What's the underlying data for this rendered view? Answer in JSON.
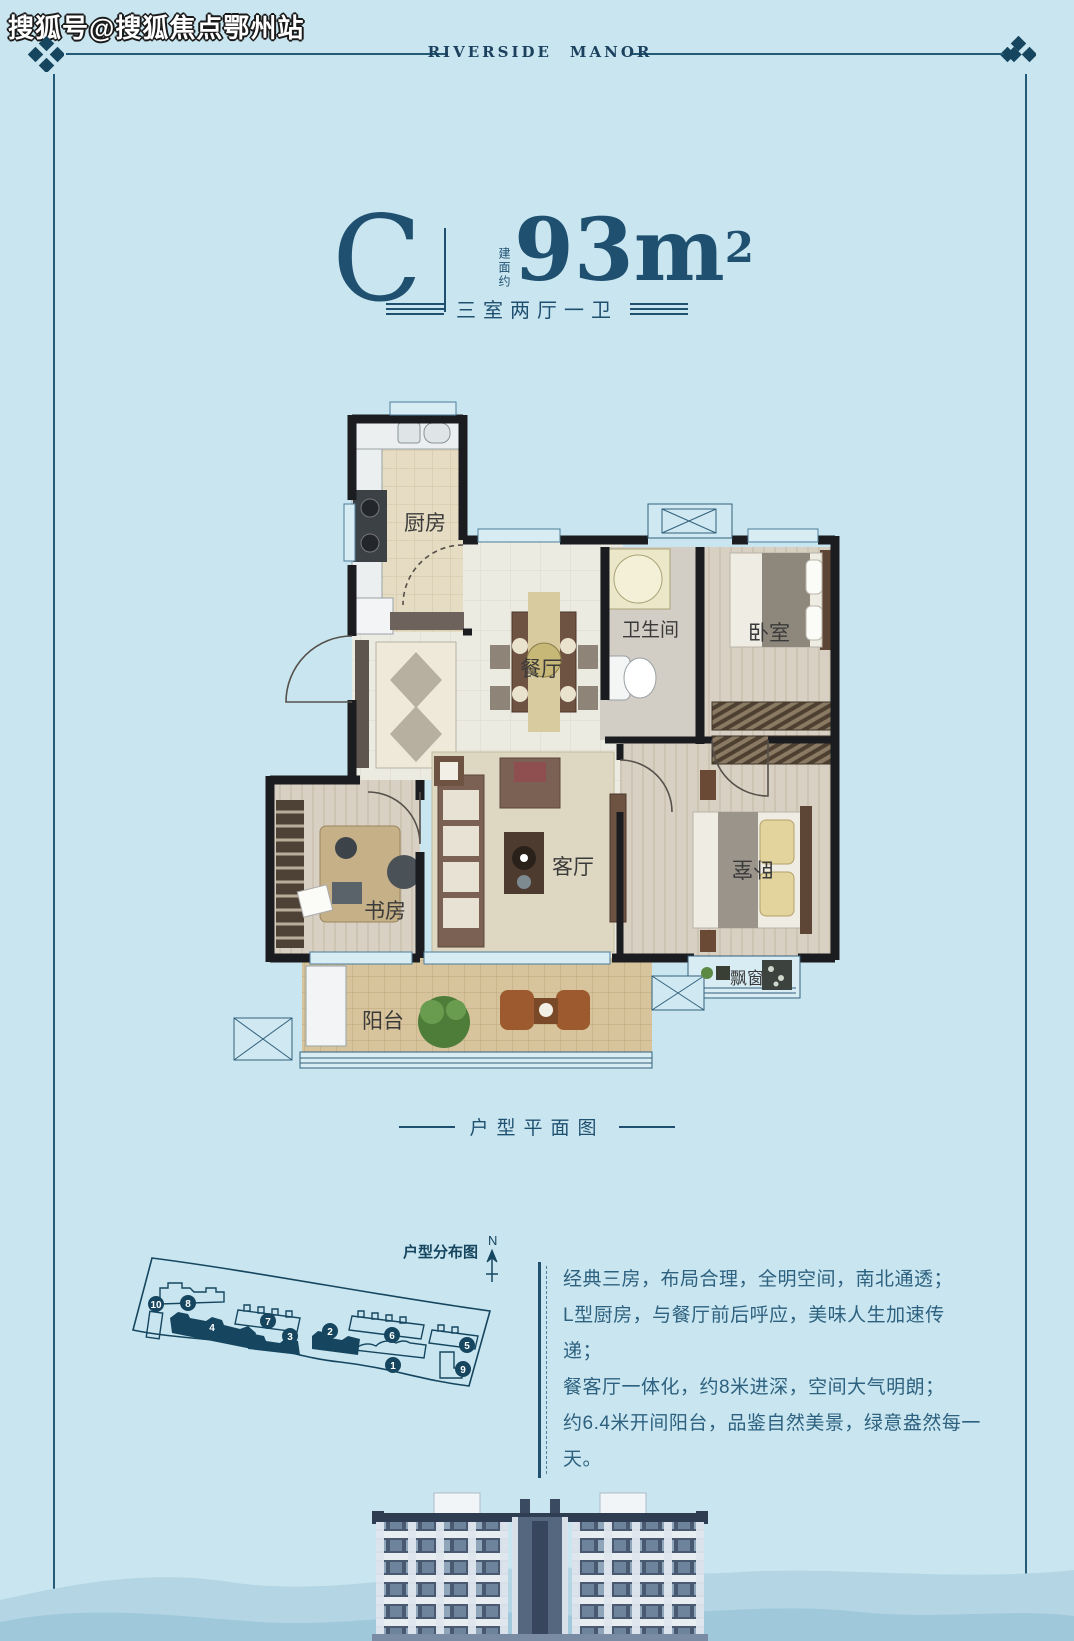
{
  "watermark": "搜狐号@搜狐焦点鄂州站",
  "brand": {
    "left": "RIVERSIDE",
    "right": "MANOR",
    "accent_color": "#a8392e"
  },
  "unit": {
    "letter": "C",
    "area_prefix": "建面约",
    "area_value": "93",
    "area_unit": "m",
    "area_sup": "2",
    "layout": "三室两厅一卫"
  },
  "plan_caption": "户型平面图",
  "floorplan": {
    "rooms": {
      "kitchen": "厨房",
      "dining": "餐厅",
      "bath": "卫生间",
      "bedroom1": "卧室",
      "living": "客厅",
      "study": "书房",
      "bedroom2": "卧室",
      "balcony": "阳台",
      "bay_window": "飘窗"
    }
  },
  "site_plan": {
    "title": "户型分布图",
    "compass": "N",
    "highlight_color": "#16465f",
    "buildings": [
      {
        "label": "1"
      },
      {
        "label": "2"
      },
      {
        "label": "3"
      },
      {
        "label": "4"
      },
      {
        "label": "5"
      },
      {
        "label": "6"
      },
      {
        "label": "7"
      },
      {
        "label": "8"
      },
      {
        "label": "9"
      },
      {
        "label": "10"
      }
    ]
  },
  "description": {
    "lines": [
      "经典三房，布局合理，全明空间，南北通透；",
      "L型厨房，与餐厅前后呼应，美味人生加速传递；",
      "餐客厅一体化，约8米进深，空间大气明朗；",
      "约6.4米开间阳台，品鉴自然美景，绿意盎然每一天。"
    ]
  },
  "colors": {
    "background": "#c9e6f0",
    "navy": "#1f5070",
    "wall": "#1a1c20",
    "red_accent": "#a8392e"
  }
}
